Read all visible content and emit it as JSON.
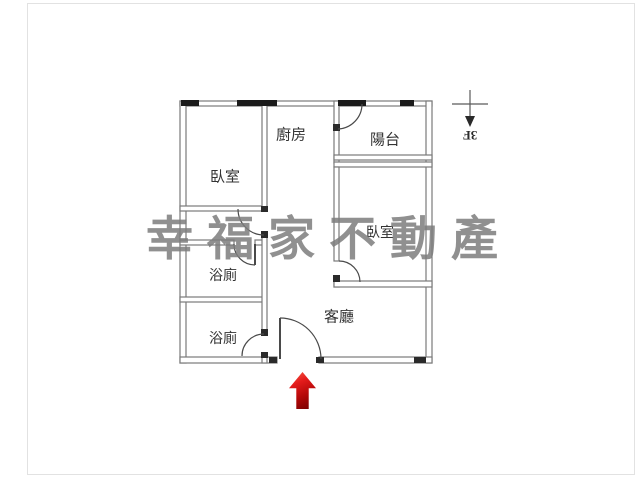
{
  "page": {
    "background": "#ffffff",
    "frame_border_color": "#e2e2e2"
  },
  "floor_plan": {
    "rooms": [
      {
        "id": "bedroom-1",
        "label": "臥室"
      },
      {
        "id": "kitchen",
        "label": "廚房"
      },
      {
        "id": "balcony",
        "label": "陽台"
      },
      {
        "id": "bedroom-2",
        "label": "臥室"
      },
      {
        "id": "bathroom-1",
        "label": "浴廁"
      },
      {
        "id": "bathroom-2",
        "label": "浴廁"
      },
      {
        "id": "living-room",
        "label": "客廳"
      }
    ],
    "compass": {
      "floor_label": "3F"
    },
    "watermark": {
      "text": "幸福家不動產",
      "color": "rgba(124,124,124,0.85)"
    },
    "colors": {
      "wall_stroke": "#7a7a7a",
      "wall_fill": "#ffffff",
      "window": "#1b1b1b",
      "door_arc": "#4a4a4a",
      "label_text": "#333333",
      "entrance_arrow_top": "#f6604a",
      "entrance_arrow_bottom": "#6f0000"
    }
  }
}
